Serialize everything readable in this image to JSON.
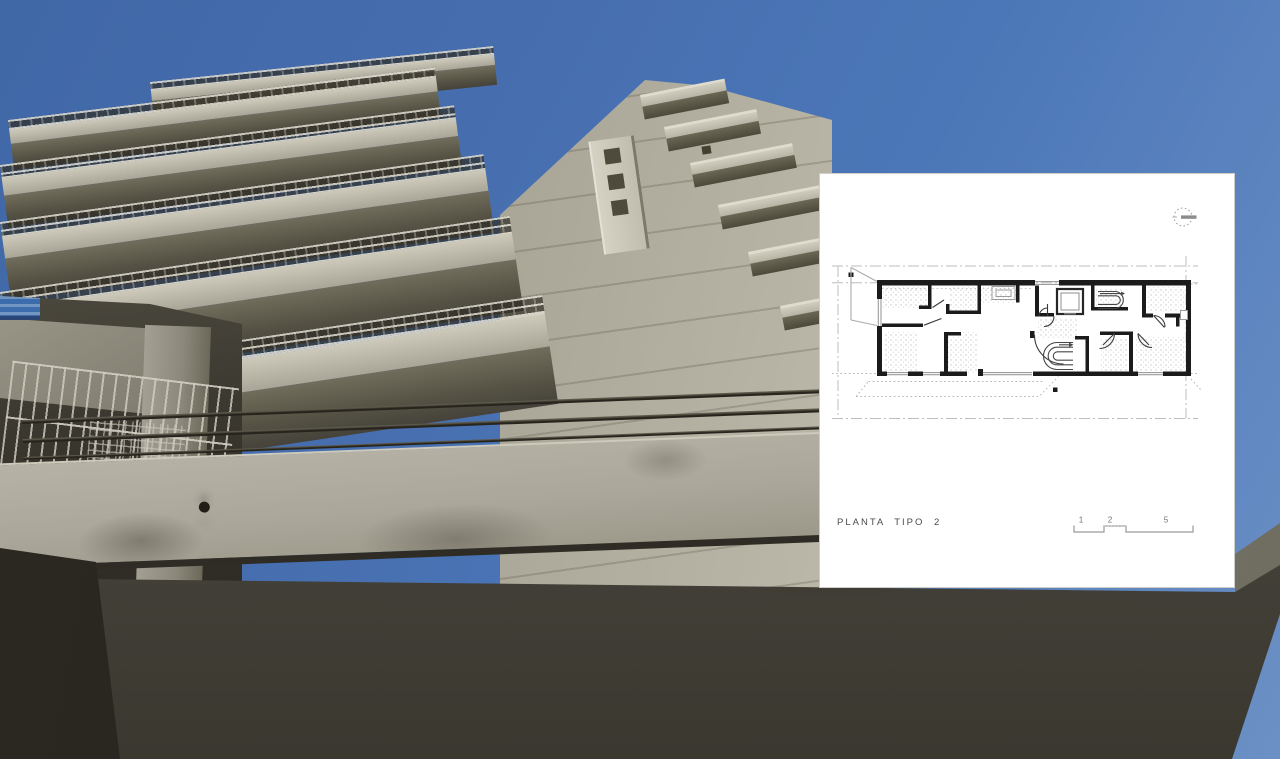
{
  "panel": {
    "title": "PLANTA TIPO 2",
    "scale_bar": {
      "labels": [
        "1",
        "2",
        "5"
      ]
    },
    "icons": {
      "north_indicator": "dashed-circle-with-bar"
    }
  },
  "colors": {
    "sky": "#4b77b8",
    "building_light": "#b6b2a6",
    "building_shadow": "#3a382f",
    "panel_background": "#ffffff",
    "plan_wall": "#1b1b1b",
    "plan_reference_line": "#bdbdbd",
    "plan_text": "#4a4a4a"
  }
}
